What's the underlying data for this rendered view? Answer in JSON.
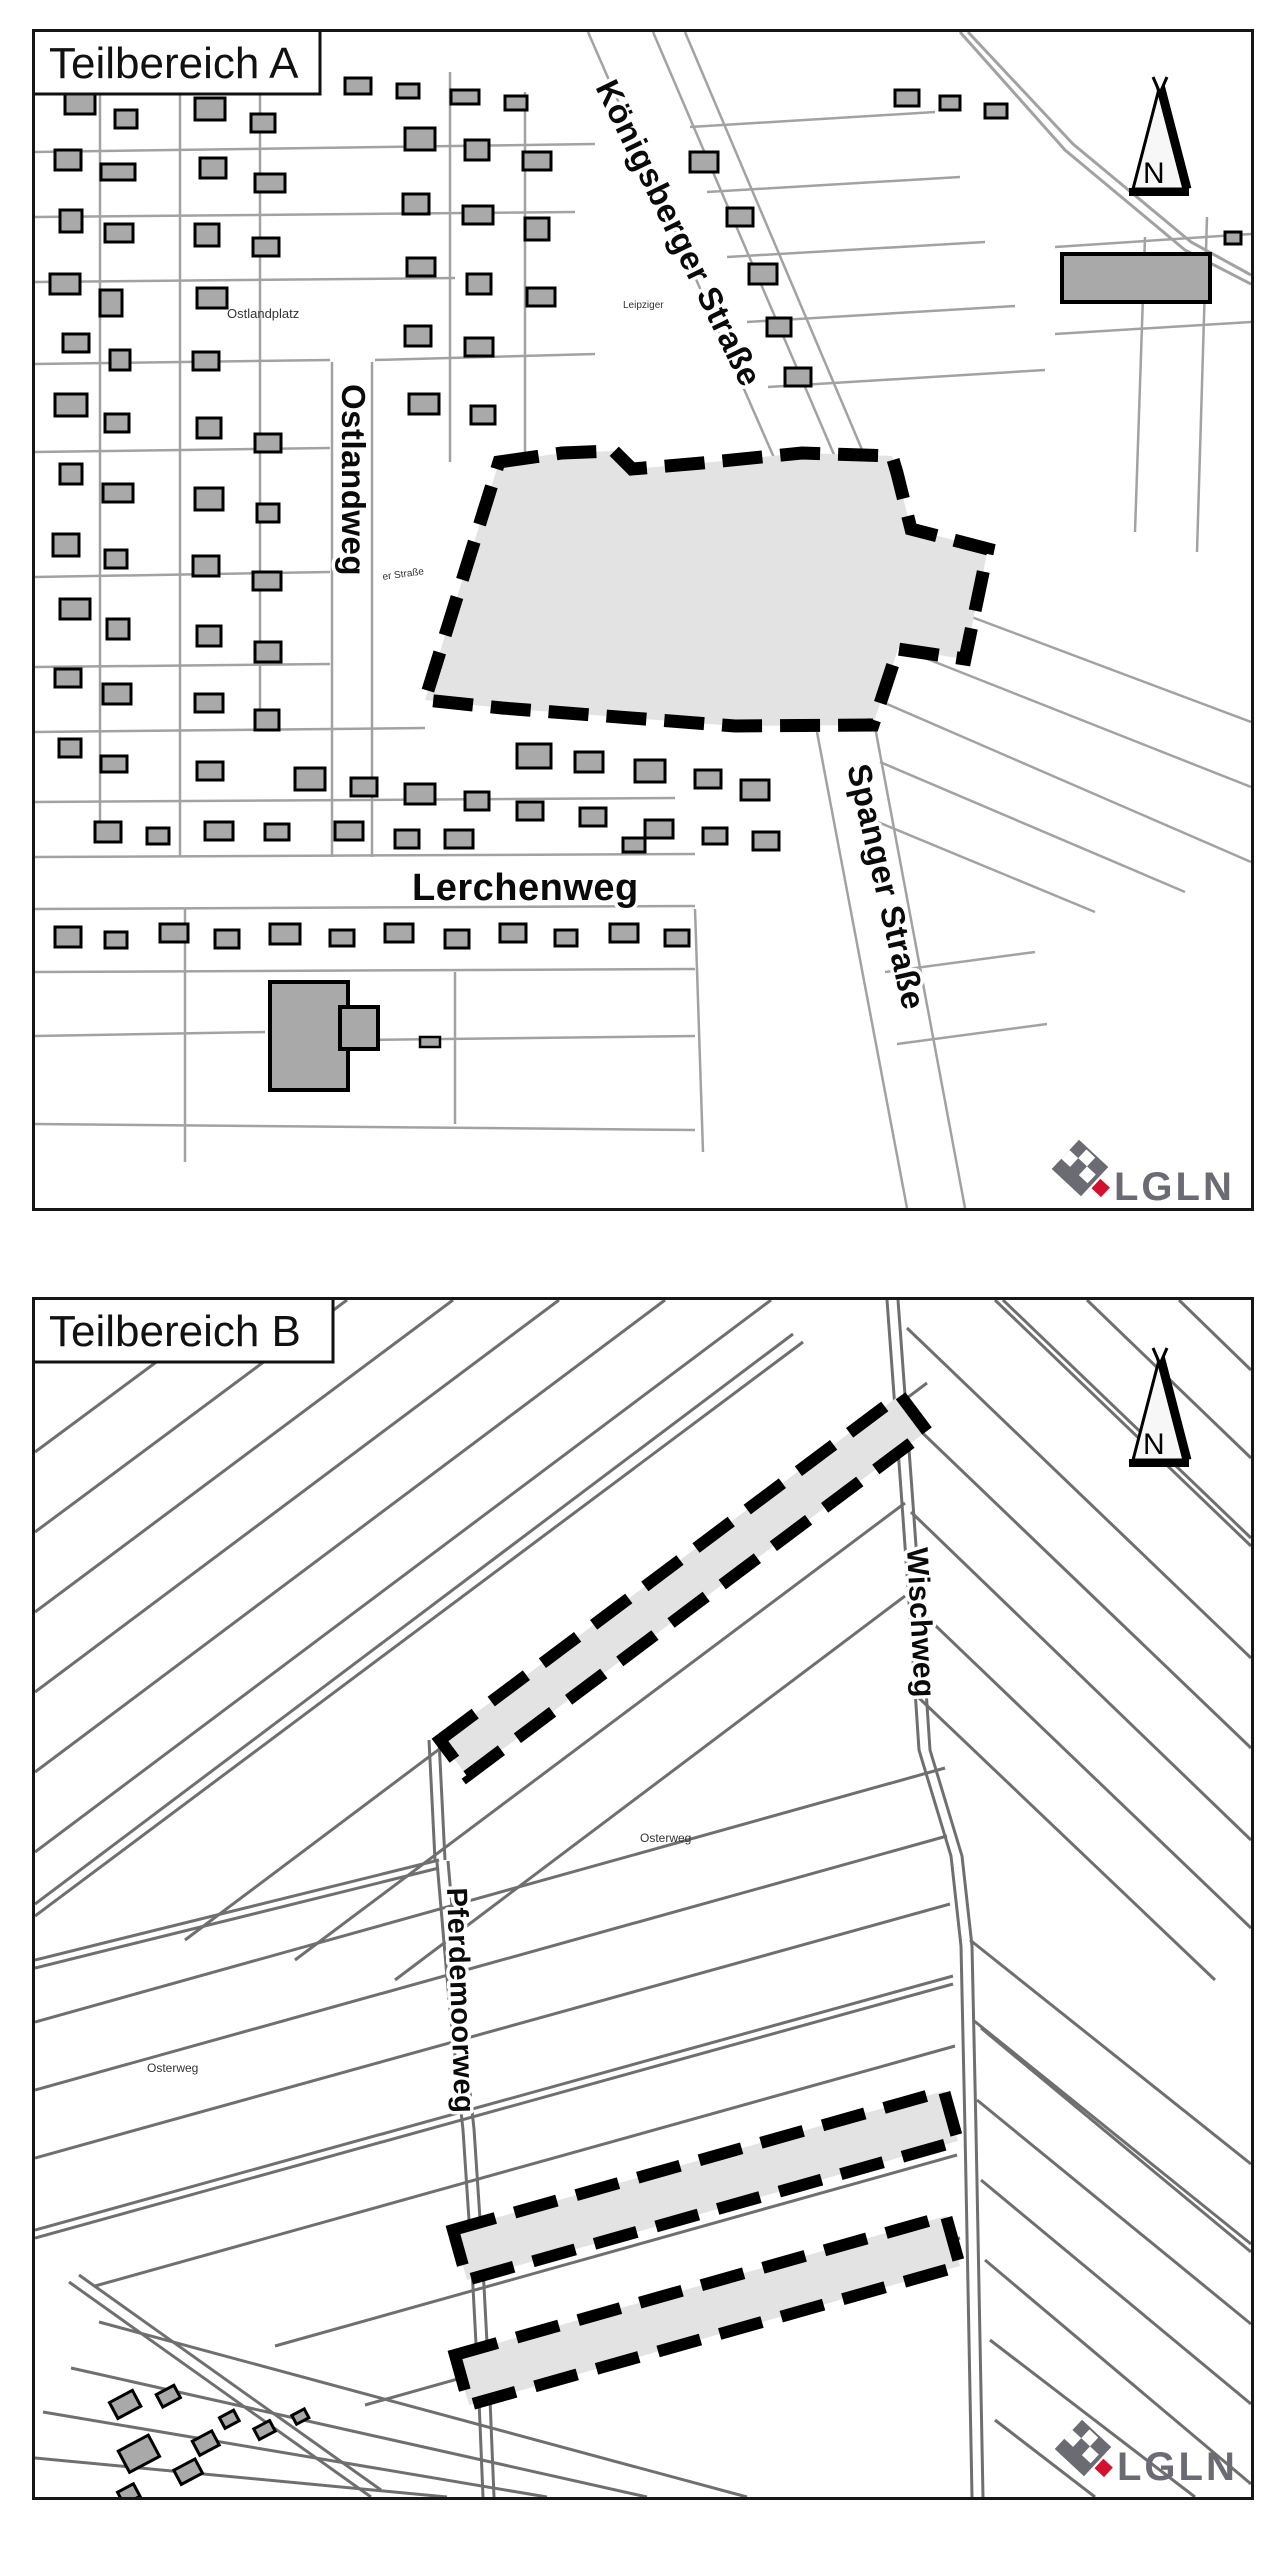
{
  "panels": [
    {
      "id": "A",
      "title": "Teilbereich A",
      "streets": {
        "koenigsberger": "Königsberger Straße",
        "ostlandweg": "Ostlandweg",
        "lerchenweg": "Lerchenweg",
        "spanger": "Spanger Straße"
      },
      "small_labels": {
        "ostlandplatz": "Ostlandplatz",
        "leipziger": "Leipziger",
        "er_strasse": "er Straße"
      }
    },
    {
      "id": "B",
      "title": "Teilbereich B",
      "streets": {
        "wischweg": "Wischweg",
        "pferdemoorweg": "Pferdemoorweg"
      },
      "small_labels": {
        "osterweg1": "Osterweg",
        "osterweg2": "Osterweg"
      }
    }
  ],
  "north_label": "N",
  "logo_text": "LGLN",
  "colors": {
    "logo_gray": "#6b6b74",
    "logo_red": "#d60f2c",
    "plan_fill": "#e3e3e3",
    "building_fill": "#a9a9a9",
    "parcel_line_a": "#a2a2a2",
    "parcel_line_b": "#6f6f6f"
  }
}
